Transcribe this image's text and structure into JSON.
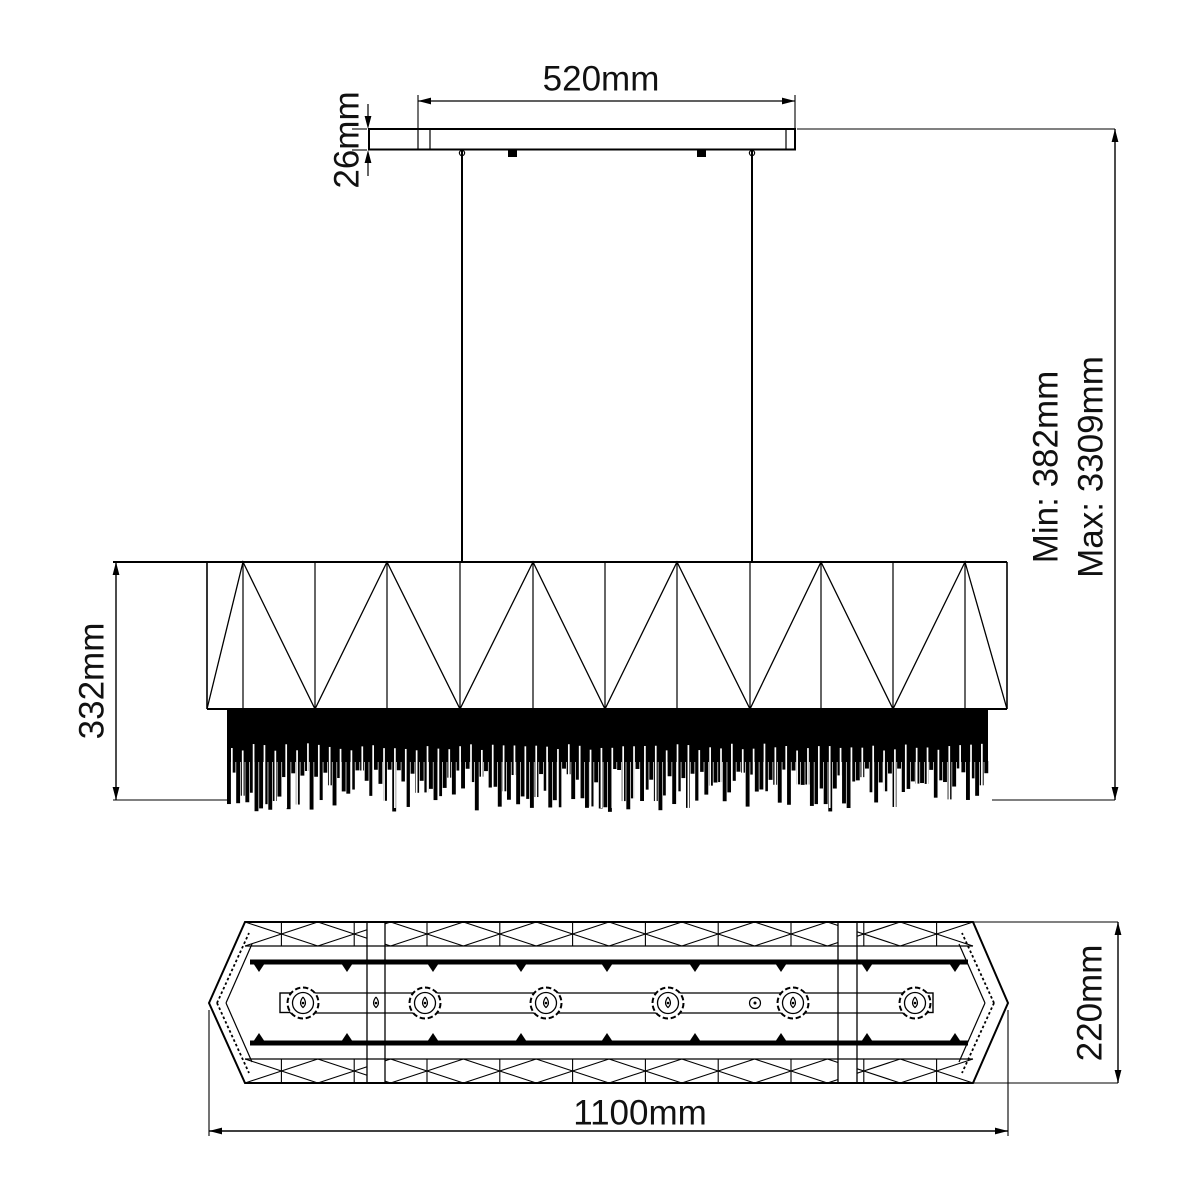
{
  "drawing": {
    "subject": "linear crystal pendant chandelier technical drawing",
    "views": [
      "side-elevation",
      "bottom-plan"
    ]
  },
  "dimensions": {
    "canopy_width": "520mm",
    "canopy_thickness": "26mm",
    "body_height": "332mm",
    "suspension_min": "Min: 382mm",
    "suspension_max": "Max: 3309mm",
    "overall_length": "1100mm",
    "overall_depth": "220mm"
  },
  "counts": {
    "bulbs": 6,
    "suspension_cables": 2,
    "crystal_peaks_side_view": 6
  },
  "colors": {
    "line": "#000000",
    "background": "#ffffff",
    "fringe": "#000000"
  }
}
